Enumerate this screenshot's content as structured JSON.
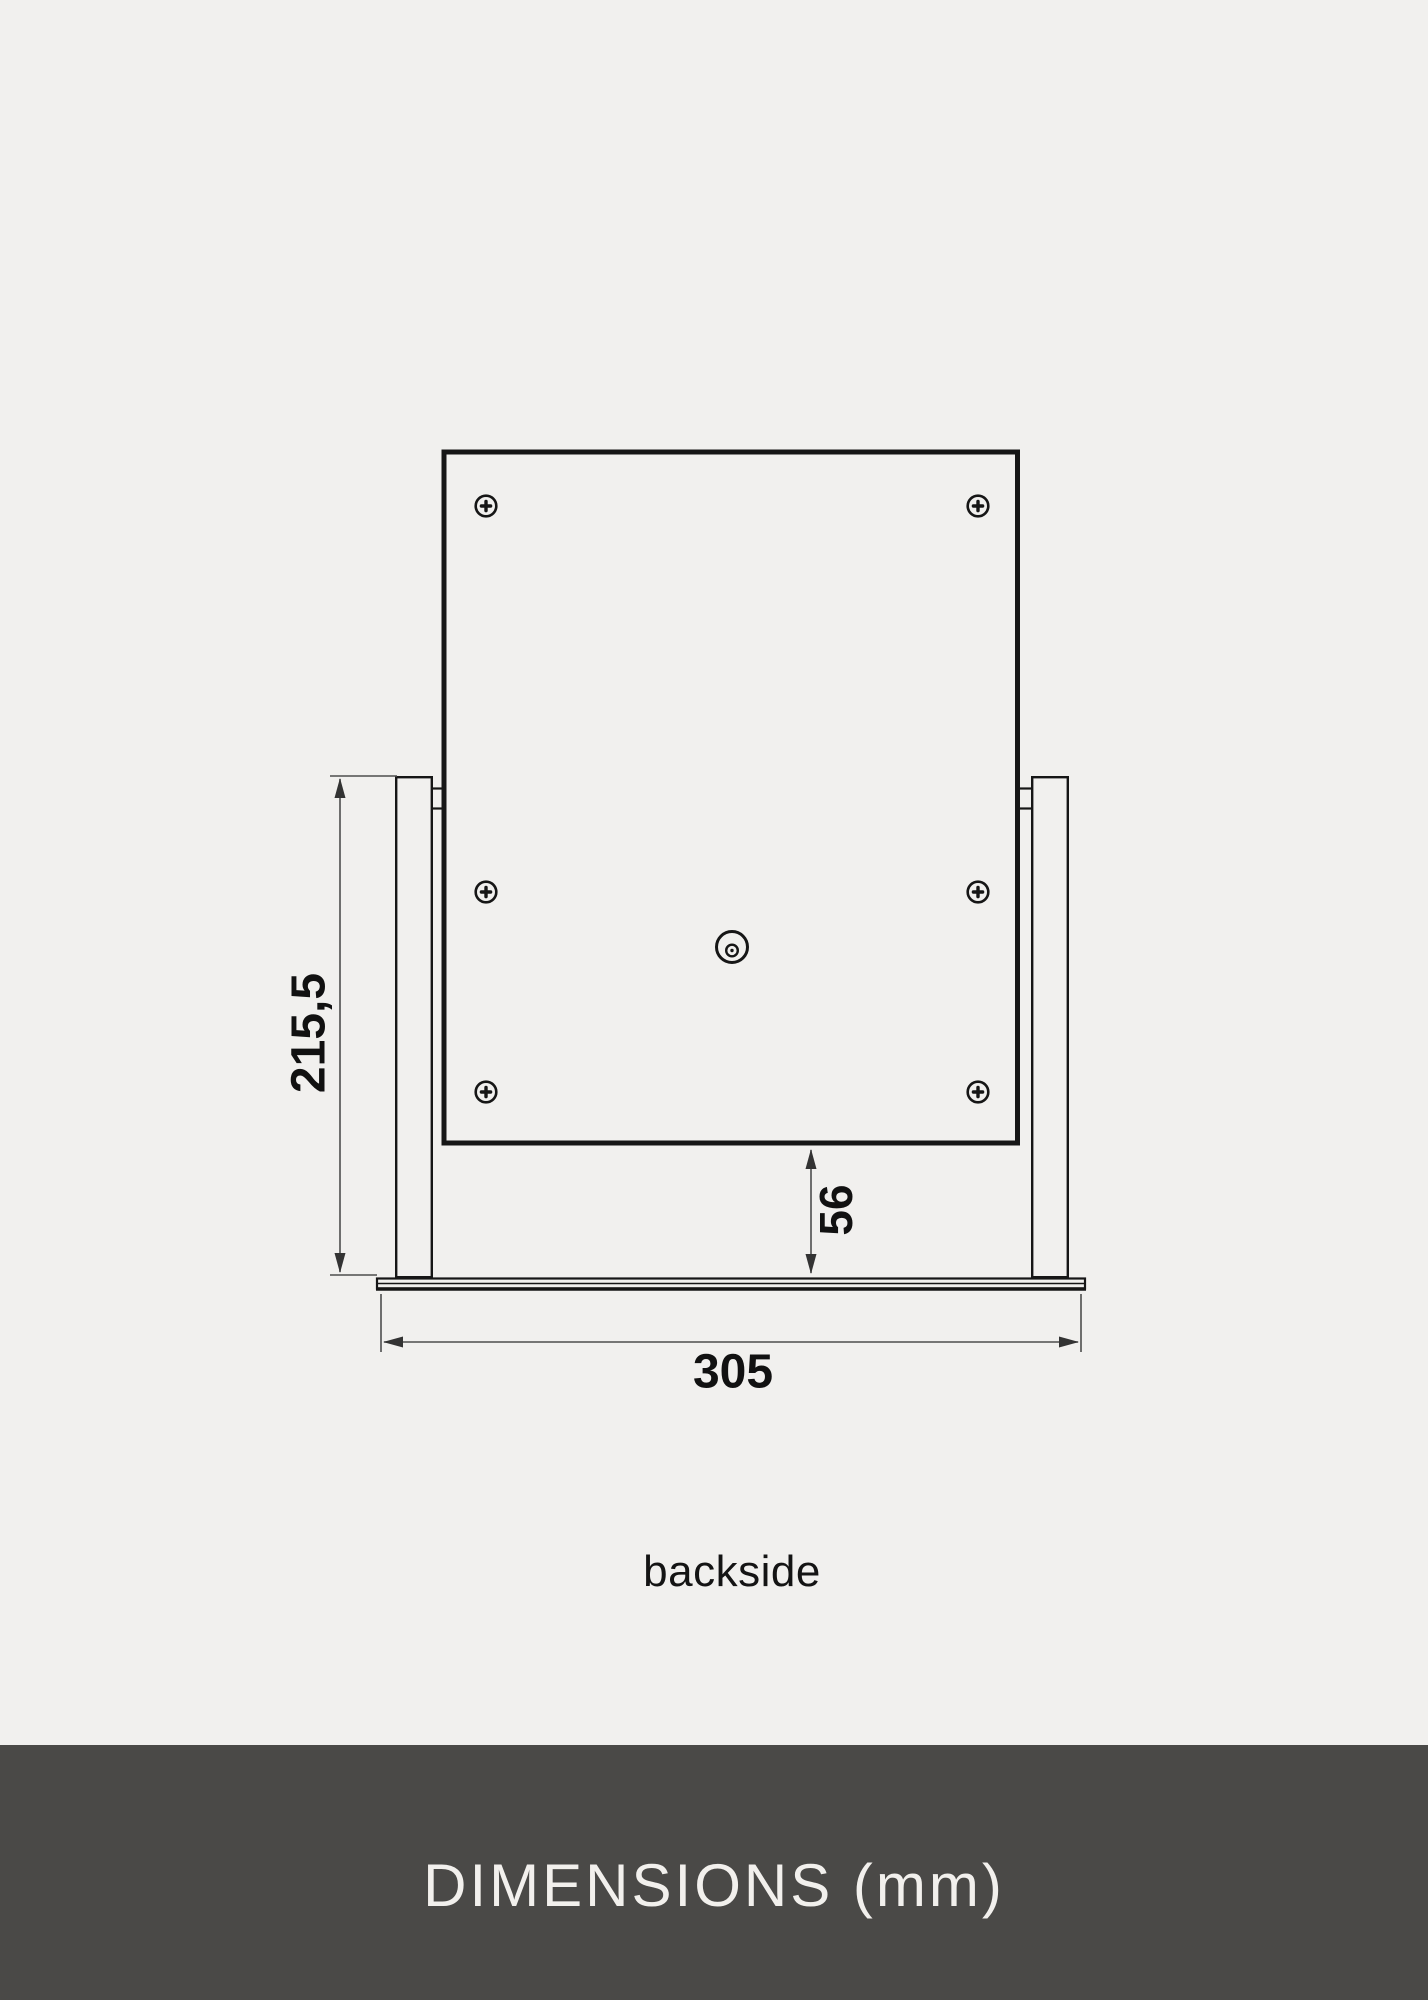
{
  "page": {
    "background_color": "#f1f0ee"
  },
  "diagram": {
    "caption": "backside",
    "line_color": "#161616",
    "dimension_line_color": "#4d4d4d",
    "dimensions": {
      "stand_height": "215,5",
      "base_offset": "56",
      "base_width": "305"
    }
  },
  "footer": {
    "title": "DIMENSIONS (mm)",
    "background_color": "#4a4947",
    "text_color": "#f2f0ed"
  }
}
